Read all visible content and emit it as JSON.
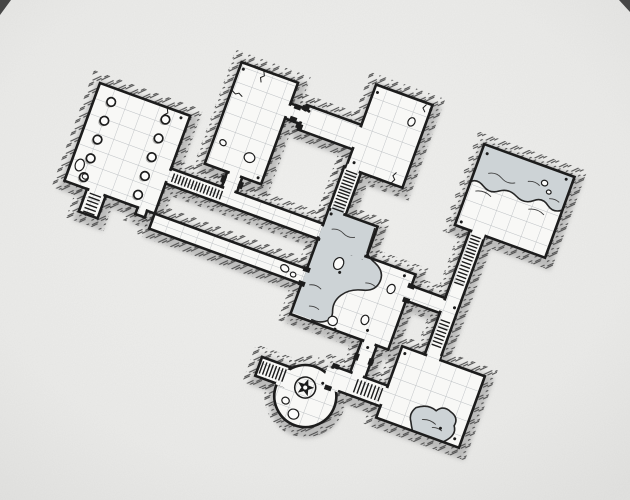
{
  "canvas": {
    "width": 630,
    "height": 500,
    "rotation_deg": 20,
    "anchor_x": 100,
    "anchor_y": 83
  },
  "palette": {
    "paper_center": "#f1f1ef",
    "paper_edge": "#e4e4e2",
    "floor": "#f8f8f6",
    "grid": "#bcc0c3",
    "wall": "#1c1c1c",
    "hatch": "#4a4a4a",
    "shadow": "#9e9e9e",
    "water": "#cdd3d6",
    "water_edge": "#262626",
    "ripple": "#3f3f3f",
    "corner_mark": "#353535",
    "stone_fill": "#fcfcfb"
  },
  "map": {
    "floors": [
      {
        "name": "pillared-hall",
        "kind": "rect",
        "x": 0,
        "y": 0,
        "w": 96,
        "h": 104
      },
      {
        "name": "hall-stair-alcove",
        "kind": "rect",
        "x": 24,
        "y": 104,
        "w": 20,
        "h": 24
      },
      {
        "name": "hall-notch",
        "kind": "rect",
        "x": 78,
        "y": 104,
        "w": 10,
        "h": 7
      },
      {
        "name": "west-stair-corridor",
        "kind": "rect",
        "x": 96,
        "y": 56,
        "w": 162,
        "h": 16
      },
      {
        "name": "north-hall",
        "kind": "rect",
        "x": 126,
        "y": -68,
        "w": 60,
        "h": 108
      },
      {
        "name": "north-hall-door-passage",
        "kind": "rect",
        "x": 150,
        "y": 40,
        "w": 16,
        "h": 16
      },
      {
        "name": "east-door-passage",
        "kind": "rect",
        "x": 186,
        "y": -46,
        "w": 16,
        "h": 16
      },
      {
        "name": "link-gallery",
        "kind": "rect",
        "x": 202,
        "y": -50,
        "w": 58,
        "h": 26
      },
      {
        "name": "guard-room",
        "kind": "rect",
        "x": 260,
        "y": -93,
        "w": 60,
        "h": 88
      },
      {
        "name": "guard-stair-shaft",
        "kind": "rect",
        "x": 258,
        "y": -5,
        "w": 18,
        "h": 45
      },
      {
        "name": "flooded-annex",
        "kind": "rect",
        "x": 258,
        "y": 40,
        "w": 52,
        "h": 32
      },
      {
        "name": "flooded-chamber",
        "kind": "rect",
        "x": 258,
        "y": 72,
        "w": 104,
        "h": 80
      },
      {
        "name": "long-south-corridor",
        "kind": "rect",
        "x": 96,
        "y": 104,
        "w": 162,
        "h": 16
      },
      {
        "name": "east-landing",
        "kind": "rect",
        "x": 362,
        "y": 84,
        "w": 36,
        "h": 16
      },
      {
        "name": "east-stair-shaft",
        "kind": "rect",
        "x": 398,
        "y": 12,
        "w": 16,
        "h": 132
      },
      {
        "name": "cistern-room",
        "kind": "rect",
        "x": 382,
        "y": -74,
        "w": 96,
        "h": 86
      },
      {
        "name": "store-room",
        "kind": "rect",
        "x": 374,
        "y": 144,
        "w": 88,
        "h": 76
      },
      {
        "name": "south-shaft",
        "kind": "rect",
        "x": 334,
        "y": 152,
        "w": 16,
        "h": 34
      },
      {
        "name": "south-corridor",
        "kind": "rect",
        "x": 316,
        "y": 186,
        "w": 58,
        "h": 22
      },
      {
        "name": "rotunda",
        "kind": "circle",
        "cx": 300,
        "cy": 224,
        "r": 31
      },
      {
        "name": "rotunda-stair-stub",
        "kind": "rect",
        "x": 246,
        "y": 202,
        "w": 30,
        "h": 20
      }
    ],
    "patches": [
      [
        92,
        58.5,
        8,
        11,
        "g"
      ],
      [
        152.5,
        36,
        11,
        8,
        "g"
      ],
      [
        152.5,
        52,
        11,
        8,
        "g"
      ],
      [
        182,
        -43.5,
        8,
        11,
        "g"
      ],
      [
        198,
        -43.5,
        8,
        11,
        "g"
      ],
      [
        256,
        -47.5,
        8,
        21,
        "g"
      ],
      [
        260.5,
        -9,
        13,
        8,
        "g"
      ],
      [
        260.5,
        36,
        13,
        8,
        "w"
      ],
      [
        254,
        58.5,
        4,
        11,
        "g"
      ],
      [
        258,
        58.5,
        4.5,
        11,
        "w"
      ],
      [
        254,
        106.5,
        4,
        11,
        "g"
      ],
      [
        258,
        106.5,
        4.5,
        11,
        "w"
      ],
      [
        260.5,
        68,
        47,
        8,
        "w"
      ],
      [
        358,
        86.5,
        8,
        11,
        "g"
      ],
      [
        394,
        86.5,
        8,
        11,
        "g"
      ],
      [
        400.5,
        8,
        13,
        8,
        "g"
      ],
      [
        400.5,
        140,
        13,
        8,
        "g"
      ],
      [
        336.5,
        148,
        11,
        8,
        "g"
      ],
      [
        336.5,
        182,
        11,
        8,
        "g"
      ],
      [
        370,
        188.5,
        8,
        17,
        "g"
      ],
      [
        311,
        189,
        18,
        20.5,
        "g"
      ],
      [
        268,
        205,
        12,
        18,
        "g"
      ],
      [
        26.5,
        100,
        15,
        8,
        "g"
      ],
      [
        79.5,
        100.5,
        7,
        7,
        "g"
      ]
    ],
    "stairs": [
      [
        27,
        107,
        14,
        19,
        "v"
      ],
      [
        101,
        58.5,
        24,
        11,
        "u"
      ],
      [
        128,
        58.5,
        24,
        11,
        "u"
      ],
      [
        260,
        -2,
        14,
        20,
        "v"
      ],
      [
        260,
        21,
        14,
        17,
        "v"
      ],
      [
        400,
        16,
        12,
        24,
        "v"
      ],
      [
        400,
        44,
        12,
        22,
        "v"
      ],
      [
        400,
        106,
        12,
        26,
        "v"
      ],
      [
        344,
        189,
        26,
        16,
        "u"
      ],
      [
        249,
        204.5,
        24,
        15,
        "u"
      ]
    ],
    "doors": [
      [
        146.5,
        44.5,
        5,
        7
      ],
      [
        164.5,
        44.5,
        5,
        7
      ],
      [
        190.5,
        -47.5,
        7,
        5
      ],
      [
        190.5,
        -34.5,
        7,
        5
      ],
      [
        198.5,
        -49,
        7,
        5
      ],
      [
        198.5,
        -30,
        7,
        5
      ],
      [
        254.5,
        102,
        7,
        5
      ],
      [
        254.5,
        117,
        7,
        5
      ],
      [
        358.5,
        82,
        7,
        5
      ],
      [
        358.5,
        97,
        7,
        5
      ],
      [
        332,
        166,
        5,
        7
      ],
      [
        347.5,
        166,
        5,
        7
      ],
      [
        315,
        183,
        7,
        5
      ],
      [
        315,
        206,
        7,
        5
      ]
    ],
    "pillars": [
      [
        17,
        14
      ],
      [
        17,
        34
      ],
      [
        17,
        54
      ],
      [
        17,
        74
      ],
      [
        17,
        94
      ],
      [
        74,
        12
      ],
      [
        74,
        32
      ],
      [
        74,
        52
      ],
      [
        74,
        72
      ],
      [
        74,
        92
      ]
    ],
    "pillar_radius": 4.3,
    "stones": [
      [
        9,
        84,
        4.5,
        6,
        0
      ],
      [
        18,
        93,
        3,
        2.6,
        15
      ],
      [
        136,
        14,
        3.4,
        2.8,
        20
      ],
      [
        166,
        19,
        5.4,
        4.8,
        0
      ],
      [
        237,
        111,
        4.4,
        3.4,
        15
      ],
      [
        247,
        114,
        2.8,
        2.4,
        0
      ],
      [
        306,
        -70,
        3.4,
        4.4,
        10
      ],
      [
        452,
        -58,
        3.2,
        2.8,
        0
      ],
      [
        459,
        -51,
        2.4,
        2,
        0
      ],
      [
        286,
        88,
        4.8,
        6.2,
        8
      ],
      [
        344,
        94,
        3.8,
        4.8,
        10
      ],
      [
        330,
        132,
        3.8,
        4.8,
        0
      ],
      [
        300,
        144,
        4.8,
        4.6,
        0
      ],
      [
        283,
        235,
        3.8,
        3.4,
        0
      ],
      [
        295,
        245,
        5.4,
        5,
        0
      ]
    ],
    "dots": [
      [
        88,
        5
      ],
      [
        130,
        -62
      ],
      [
        181,
        35
      ],
      [
        206,
        -45
      ],
      [
        264,
        -86
      ],
      [
        266,
        -12
      ],
      [
        262,
        44
      ],
      [
        352,
        77
      ],
      [
        388,
        -66
      ],
      [
        471,
        -69
      ],
      [
        387,
        7
      ],
      [
        379,
        150
      ],
      [
        455,
        213
      ],
      [
        342,
        157
      ],
      [
        320,
        -88
      ],
      [
        312,
        206
      ],
      [
        305,
        151
      ],
      [
        336,
        141
      ],
      [
        290,
        96
      ],
      [
        438,
        208
      ],
      [
        410,
        90
      ]
    ],
    "cracks": [
      "M72,1 l2,4 l-3,3 l2,4",
      "M150,-67 l2,4 l-3,3 l2,4",
      "M127,-38 l4,2 l3,-2 l4,2",
      "M308,-6 l2,-4 l-3,-3 l2,-4",
      "M314,-91 l-2,4 l3,3"
    ],
    "pools": [
      {
        "name": "flooded-chamber-pool",
        "fill": "M259,41 L308,41 L309,68 Q312,72 320,75 Q332,80 331,91 Q330,102 317,105 Q305,108 299,117 Q293,126 297,136 Q299,143 293,147 Q287,152 279,150 L259,150 Z",
        "shore": "M308,43 L309,68 Q312,72 320,75 Q332,80 331,91 Q330,102 317,105 Q305,108 299,117 Q293,126 297,136 Q299,143 293,147 Q287,151 280,150",
        "ripples": [
          "M268,58 q6,-3 12,0 q6,3 12,0",
          "M295,76 q6,-3 12,0",
          "M266,118 q6,-3 12,0",
          "M273,138 q5,-2 10,0",
          "M318,97 q5,-2 10,0"
        ]
      },
      {
        "name": "cistern-pool",
        "fill": "M383,-73 L477,-73 L477,-38 Q470,-33 463,-38 Q455,-44 448,-38 Q440,-31 430,-36 Q420,-41 412,-35 Q404,-29 396,-34 Q388,-39 383,-35 Z",
        "shore": "M477,-38 Q470,-33 463,-38 Q455,-44 448,-38 Q440,-31 430,-36 Q420,-41 412,-35 Q404,-29 396,-34 Q388,-39 383,-35",
        "ripples": [
          "M396,-48 q7,-4 14,0 q7,4 14,0",
          "M436,-54 q6,-3 12,0",
          "M390,-27 q8,-4 16,0",
          "M446,-28 q8,-4 16,0",
          "M462,-45 q5,-2 10,0"
        ]
      },
      {
        "name": "store-room-puddle",
        "fill": "M412,219 L446,219 Q456,209 450,201 Q452,192 442,189 Q433,185 428,193 Q418,189 408,197 Q403,205 408,212 Q410,216 412,219 Z",
        "shore": "M446,219 Q456,209 450,201 Q452,192 442,189 Q433,185 428,193 Q418,189 408,197 Q403,205 408,212 Q410,216 412,219",
        "ripples": [
          "M418,206 q7,-3 14,0",
          "M430,210 q5,-2 10,0"
        ]
      }
    ],
    "emblem": {
      "cx": 297,
      "cy": 216,
      "ring_r": 10.5,
      "star_outer": 9,
      "star_inner": 3.8,
      "dot_r": 2.1
    },
    "corner_marks": [
      "M0,0 L11,0 L0,15 Z",
      "M630,0 L619,0 L630,12 Z"
    ]
  }
}
